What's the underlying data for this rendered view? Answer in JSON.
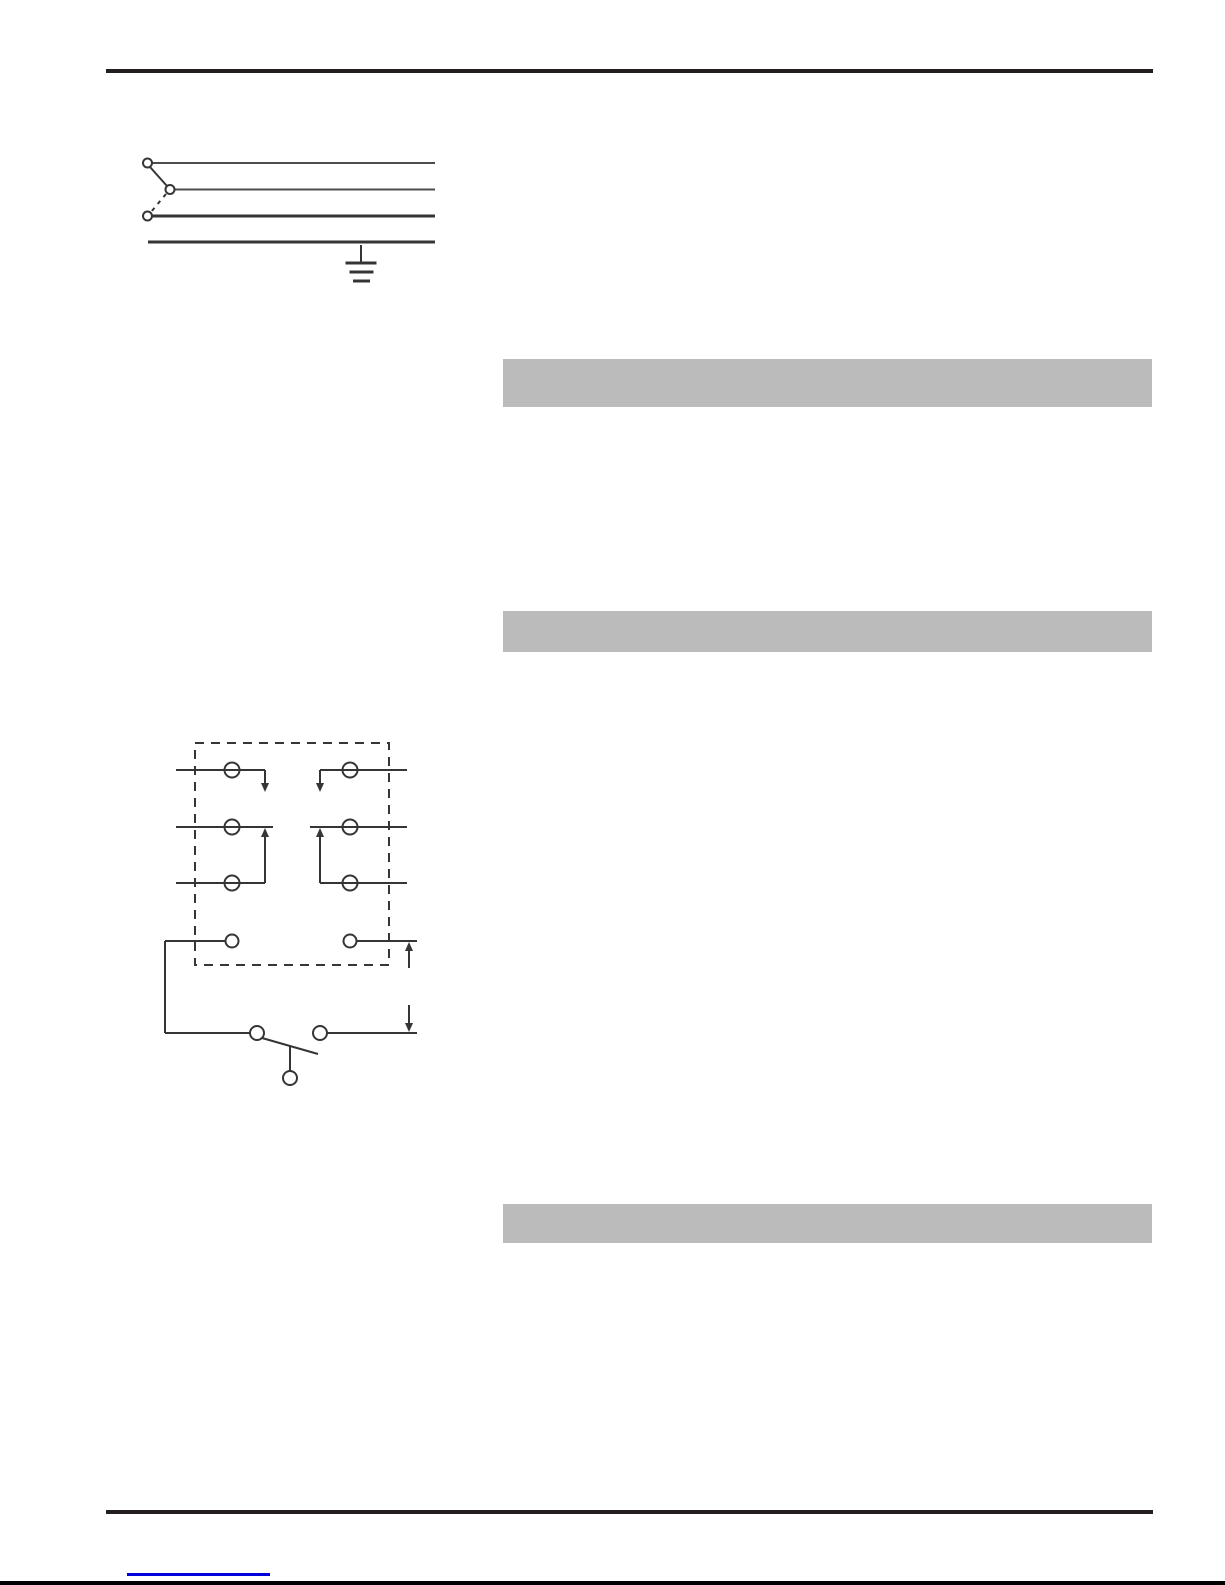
{
  "colors": {
    "page-bg": "#ffffff",
    "rule": "#231f20",
    "diagram-line": "#363435",
    "diagram-line-light": "#4d4d4d",
    "highlight-bar": "#bbbbbb",
    "link-underline": "#0000dd",
    "page-edge": "#000000"
  },
  "header": {
    "text": ""
  },
  "highlight_bars": [
    {
      "label": ""
    },
    {
      "label": ""
    },
    {
      "label": ""
    }
  ],
  "icons": {
    "ground": "earth-ground-icon",
    "switch": "selector-switch-icon",
    "relay": "relay-terminal-diagram",
    "arrow_down": "arrow-down-icon",
    "arrow_up": "arrow-up-icon"
  },
  "footer": {
    "link_text": ""
  }
}
